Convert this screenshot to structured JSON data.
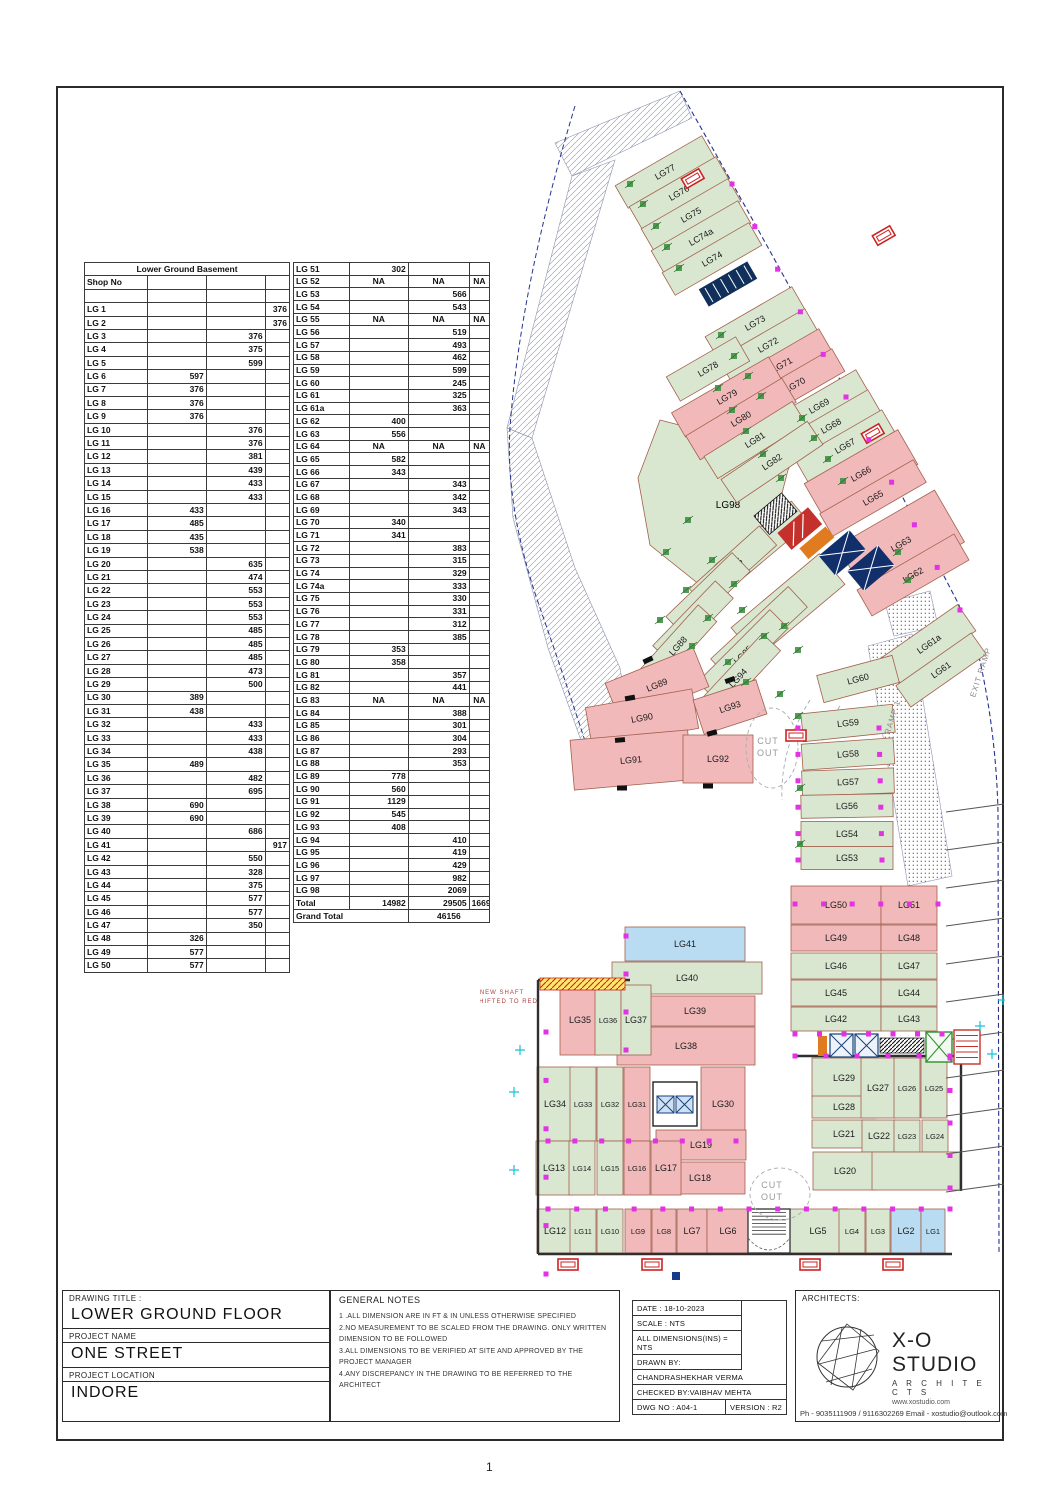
{
  "page": {
    "number": "1"
  },
  "area_table": {
    "title": "Lower Ground Basement",
    "header": "Shop No",
    "left_rows": [
      [
        "LG 1",
        "",
        "",
        "376"
      ],
      [
        "LG 2",
        "",
        "",
        "376"
      ],
      [
        "LG 3",
        "",
        "376",
        ""
      ],
      [
        "LG 4",
        "",
        "375",
        ""
      ],
      [
        "LG 5",
        "",
        "599",
        ""
      ],
      [
        "LG 6",
        "597",
        "",
        ""
      ],
      [
        "LG 7",
        "376",
        "",
        ""
      ],
      [
        "LG 8",
        "376",
        "",
        ""
      ],
      [
        "LG 9",
        "376",
        "",
        ""
      ],
      [
        "LG 10",
        "",
        "376",
        ""
      ],
      [
        "LG 11",
        "",
        "376",
        ""
      ],
      [
        "LG 12",
        "",
        "381",
        ""
      ],
      [
        "LG 13",
        "",
        "439",
        ""
      ],
      [
        "LG 14",
        "",
        "433",
        ""
      ],
      [
        "LG 15",
        "",
        "433",
        ""
      ],
      [
        "LG 16",
        "433",
        "",
        ""
      ],
      [
        "LG 17",
        "485",
        "",
        ""
      ],
      [
        "LG 18",
        "435",
        "",
        ""
      ],
      [
        "LG 19",
        "538",
        "",
        ""
      ],
      [
        "LG 20",
        "",
        "635",
        ""
      ],
      [
        "LG 21",
        "",
        "474",
        ""
      ],
      [
        "LG 22",
        "",
        "553",
        ""
      ],
      [
        "LG 23",
        "",
        "553",
        ""
      ],
      [
        "LG 24",
        "",
        "553",
        ""
      ],
      [
        "LG 25",
        "",
        "485",
        ""
      ],
      [
        "LG 26",
        "",
        "485",
        ""
      ],
      [
        "LG 27",
        "",
        "485",
        ""
      ],
      [
        "LG 28",
        "",
        "473",
        ""
      ],
      [
        "LG 29",
        "",
        "500",
        ""
      ],
      [
        "LG 30",
        "389",
        "",
        ""
      ],
      [
        "LG 31",
        "438",
        "",
        ""
      ],
      [
        "LG 32",
        "",
        "433",
        ""
      ],
      [
        "LG 33",
        "",
        "433",
        ""
      ],
      [
        "LG 34",
        "",
        "438",
        ""
      ],
      [
        "LG 35",
        "489",
        "",
        ""
      ],
      [
        "LG 36",
        "",
        "482",
        ""
      ],
      [
        "LG 37",
        "",
        "695",
        ""
      ],
      [
        "LG 38",
        "690",
        "",
        ""
      ],
      [
        "LG 39",
        "690",
        "",
        ""
      ],
      [
        "LG 40",
        "",
        "686",
        ""
      ],
      [
        "LG 41",
        "",
        "",
        "917"
      ],
      [
        "LG 42",
        "",
        "550",
        ""
      ],
      [
        "LG 43",
        "",
        "328",
        ""
      ],
      [
        "LG 44",
        "",
        "375",
        ""
      ],
      [
        "LG 45",
        "",
        "577",
        ""
      ],
      [
        "LG 46",
        "",
        "577",
        ""
      ],
      [
        "LG 47",
        "",
        "350",
        ""
      ],
      [
        "LG 48",
        "326",
        "",
        ""
      ],
      [
        "LG 49",
        "577",
        "",
        ""
      ],
      [
        "LG 50",
        "577",
        "",
        ""
      ]
    ],
    "right_rows": [
      [
        "LG 51",
        "302",
        "",
        ""
      ],
      [
        "LG 52",
        "NA",
        "NA",
        "NA"
      ],
      [
        "LG 53",
        "",
        "566",
        ""
      ],
      [
        "LG 54",
        "",
        "543",
        ""
      ],
      [
        "LG 55",
        "NA",
        "NA",
        "NA"
      ],
      [
        "LG 56",
        "",
        "519",
        ""
      ],
      [
        "LG 57",
        "",
        "493",
        ""
      ],
      [
        "LG 58",
        "",
        "462",
        ""
      ],
      [
        "LG 59",
        "",
        "599",
        ""
      ],
      [
        "LG 60",
        "",
        "245",
        ""
      ],
      [
        "LG 61",
        "",
        "325",
        ""
      ],
      [
        "LG 61a",
        "",
        "363",
        ""
      ],
      [
        "LG 62",
        "400",
        "",
        ""
      ],
      [
        "LG 63",
        "556",
        "",
        ""
      ],
      [
        "LG 64",
        "NA",
        "NA",
        "NA"
      ],
      [
        "LG 65",
        "582",
        "",
        ""
      ],
      [
        "LG 66",
        "343",
        "",
        ""
      ],
      [
        "LG 67",
        "",
        "343",
        ""
      ],
      [
        "LG 68",
        "",
        "342",
        ""
      ],
      [
        "LG 69",
        "",
        "343",
        ""
      ],
      [
        "LG 70",
        "340",
        "",
        ""
      ],
      [
        "LG 71",
        "341",
        "",
        ""
      ],
      [
        "LG 72",
        "",
        "383",
        ""
      ],
      [
        "LG 73",
        "",
        "315",
        ""
      ],
      [
        "LG 74",
        "",
        "329",
        ""
      ],
      [
        "LG 74a",
        "",
        "333",
        ""
      ],
      [
        "LG 75",
        "",
        "330",
        ""
      ],
      [
        "LG 76",
        "",
        "331",
        ""
      ],
      [
        "LG 77",
        "",
        "312",
        ""
      ],
      [
        "LG 78",
        "",
        "385",
        ""
      ],
      [
        "LG 79",
        "353",
        "",
        ""
      ],
      [
        "LG 80",
        "358",
        "",
        ""
      ],
      [
        "LG 81",
        "",
        "357",
        ""
      ],
      [
        "LG 82",
        "",
        "441",
        ""
      ],
      [
        "LG 83",
        "NA",
        "NA",
        "NA"
      ],
      [
        "LG 84",
        "",
        "388",
        ""
      ],
      [
        "LG 85",
        "",
        "301",
        ""
      ],
      [
        "LG 86",
        "",
        "304",
        ""
      ],
      [
        "LG 87",
        "",
        "293",
        ""
      ],
      [
        "LG 88",
        "",
        "353",
        ""
      ],
      [
        "LG 89",
        "778",
        "",
        ""
      ],
      [
        "LG 90",
        "560",
        "",
        ""
      ],
      [
        "LG 91",
        "1129",
        "",
        ""
      ],
      [
        "LG 92",
        "545",
        "",
        ""
      ],
      [
        "LG 93",
        "408",
        "",
        ""
      ],
      [
        "LG 94",
        "",
        "410",
        ""
      ],
      [
        "LG 95",
        "",
        "419",
        ""
      ],
      [
        "LG 96",
        "",
        "429",
        ""
      ],
      [
        "LG 97",
        "",
        "982",
        ""
      ],
      [
        "LG 98",
        "",
        "2069",
        ""
      ]
    ],
    "total_row": [
      "Total",
      "14982",
      "29505",
      "1669"
    ],
    "grand_total_label": "Grand Total",
    "grand_total_value": "46156"
  },
  "title_block": {
    "drawing_title_label": "DRAWING TITLE :",
    "drawing_title": "LOWER GROUND FLOOR",
    "project_name_label": "PROJECT NAME",
    "project_name": "ONE STREET",
    "project_location_label": "PROJECT LOCATION",
    "project_location": "INDORE",
    "general_notes_title": "GENERAL NOTES",
    "notes": [
      "1 .ALL DIMENSION ARE IN FT & IN UNLESS OTHERWISE SPECIFIED",
      "2.NO MEASUREMENT TO BE SCALED FROM THE DRAWING. ONLY WRITTEN DIMENSION TO BE FOLLOWED",
      "3.ALL DIMENSIONS TO BE VERIFIED AT SITE AND APPROVED BY THE PROJECT MANAGER",
      "4.ANY DISCREPANCY IN THE DRAWING TO BE REFERRED TO THE ARCHITECT"
    ],
    "date": "DATE : 18-10-2023",
    "scale": "SCALE : NTS",
    "all_dim": "ALL DIMENSIONS(INS) = NTS",
    "drawn_by_label": "DRAWN BY:",
    "drawn_by": "CHANDRASHEKHAR VERMA",
    "checked_by": "CHECKED BY:VAIBHAV MEHTA",
    "dwg_no": "DWG NO : A04-1",
    "version": "VERSION : R2",
    "architects_label": "ARCHITECTS:",
    "studio_name": "X-O STUDIO",
    "studio_sub": "A R C H I T E C T S",
    "studio_web": "www.xostudio.com",
    "contact": "Ph - 9035111909 / 9116302269 Email - xostudio@outlook.com"
  },
  "floor_plan": {
    "annotations": {
      "cut_out": "CUT OUT",
      "ramp1": "RAMP 1",
      "exit_ramp": "EXIT RAMP",
      "shaft_line1": "NEW SHAFT",
      "shaft_line2": "SHIFTED TO RED"
    },
    "colors": {
      "green": "#d9e7d1",
      "pink": "#f2b9bb",
      "blue": "#badcf2",
      "white": "#ffffff",
      "shop_line": "#a2604c",
      "magenta": "#e332e3",
      "navy": "#25338f",
      "plant": "#3f9142"
    },
    "big_shop": {
      "id": "LG98",
      "points": "180,332 315,367 308,382 290,452 220,497 170,457 158,390",
      "lx": 248,
      "ly": 420
    },
    "shops": [
      [
        "LG77",
        185,
        84,
        100,
        26,
        -30,
        "g"
      ],
      [
        "LG76",
        199,
        105,
        100,
        26,
        -30,
        "g"
      ],
      [
        "LG75",
        211,
        127,
        100,
        26,
        -30,
        "g"
      ],
      [
        "LC74a",
        221,
        149,
        100,
        26,
        -30,
        "g"
      ],
      [
        "LG74",
        232,
        171,
        100,
        26,
        -30,
        "g"
      ],
      [
        "LG73",
        275,
        235,
        100,
        26,
        -30,
        "g"
      ],
      [
        "LG72",
        288,
        257,
        100,
        26,
        -30,
        "g"
      ],
      [
        "LG71",
        302,
        277,
        100,
        26,
        -30,
        "p"
      ],
      [
        "LG70",
        315,
        297,
        100,
        26,
        -30,
        "p"
      ],
      [
        "LG69",
        339,
        318,
        100,
        26,
        -30,
        "g"
      ],
      [
        "LG68",
        351,
        338,
        100,
        26,
        -30,
        "g"
      ],
      [
        "LG67",
        365,
        358,
        100,
        26,
        -30,
        "g"
      ],
      [
        "LG66",
        381,
        386,
        108,
        40,
        -30,
        "p"
      ],
      [
        "LG65",
        393,
        410,
        108,
        26,
        -30,
        "p"
      ],
      [
        "LG63",
        421,
        456,
        112,
        60,
        -30,
        "p"
      ],
      [
        "LG62",
        433,
        487,
        112,
        30,
        -30,
        "p"
      ],
      [
        "LG61a",
        449,
        556,
        92,
        32,
        -35,
        "g"
      ],
      [
        "LG61",
        461,
        582,
        92,
        26,
        -35,
        "g"
      ],
      [
        "LG78",
        228,
        281,
        80,
        28,
        -30,
        "g"
      ],
      [
        "LG79",
        247,
        309,
        112,
        28,
        -30,
        "p"
      ],
      [
        "LG80",
        261,
        331,
        112,
        28,
        -31,
        "p"
      ],
      [
        "LG81",
        275,
        352,
        104,
        26,
        -32,
        "g"
      ],
      [
        "LG82",
        292,
        374,
        104,
        28,
        -34,
        "g"
      ],
      [
        "LG84",
        282,
        456,
        100,
        28,
        -40,
        "g"
      ],
      [
        "LG85",
        253,
        479,
        94,
        26,
        -42,
        "g"
      ],
      [
        "LG86",
        228,
        506,
        92,
        26,
        -44,
        "g"
      ],
      [
        "LG87",
        213,
        534,
        90,
        25,
        -46,
        "g"
      ],
      [
        "LG88",
        198,
        558,
        88,
        25,
        -48,
        "g"
      ],
      [
        "LG97",
        308,
        518,
        115,
        40,
        -40,
        "g"
      ],
      [
        "LG96",
        279,
        545,
        106,
        28,
        -43,
        "g"
      ],
      [
        "LG95",
        263,
        567,
        102,
        26,
        -45,
        "g"
      ],
      [
        "LG94",
        258,
        590,
        98,
        25,
        -47,
        "g"
      ],
      [
        "LG89",
        177,
        597,
        95,
        42,
        -22,
        "p"
      ],
      [
        "LG90",
        162,
        630,
        108,
        40,
        -10,
        "p"
      ],
      [
        "LG91",
        151,
        672,
        118,
        50,
        -5,
        "p"
      ],
      [
        "LG93",
        250,
        619,
        66,
        36,
        -18,
        "p"
      ],
      [
        "LG92",
        238,
        671,
        70,
        48,
        0,
        "p"
      ],
      [
        "LG60",
        378,
        591,
        78,
        28,
        -15,
        "g"
      ],
      [
        "LG59",
        368,
        635,
        92,
        28,
        -6,
        "g"
      ],
      [
        "LG58",
        368,
        666,
        92,
        26,
        -4,
        "g"
      ],
      [
        "LG57",
        368,
        694,
        92,
        25,
        -2,
        "g"
      ],
      [
        "LG56",
        367,
        718,
        92,
        23,
        -1,
        "g"
      ],
      [
        "LG54",
        367,
        746,
        92,
        25,
        0,
        "g"
      ],
      [
        "LG53",
        367,
        770,
        92,
        23,
        0,
        "g"
      ],
      [
        "LG50",
        356,
        817,
        90,
        38,
        0,
        "p"
      ],
      [
        "LG51",
        429,
        817,
        56,
        38,
        0,
        "p"
      ],
      [
        "LG49",
        356,
        850,
        90,
        26,
        0,
        "p"
      ],
      [
        "LG48",
        429,
        850,
        56,
        26,
        0,
        "p"
      ],
      [
        "LG46",
        356,
        878,
        90,
        26,
        0,
        "g"
      ],
      [
        "LG47",
        429,
        878,
        56,
        26,
        0,
        "g"
      ],
      [
        "LG45",
        356,
        905,
        90,
        26,
        0,
        "g"
      ],
      [
        "LG44",
        429,
        905,
        56,
        26,
        0,
        "g"
      ],
      [
        "LG42",
        356,
        931,
        90,
        24,
        0,
        "g"
      ],
      [
        "LG43",
        429,
        931,
        56,
        24,
        0,
        "g"
      ],
      [
        "LG41",
        205,
        856,
        120,
        34,
        0,
        "b"
      ],
      [
        "LG40",
        207,
        890,
        150,
        32,
        0,
        "g"
      ],
      [
        "LG39",
        215,
        923,
        120,
        30,
        0,
        "p"
      ],
      [
        "LG38",
        206,
        958,
        138,
        38,
        0,
        "p"
      ],
      [
        "LG35",
        100,
        932,
        40,
        70,
        0,
        "p"
      ],
      [
        "LG36",
        128,
        932,
        26,
        70,
        0,
        "g"
      ],
      [
        "LG37",
        156,
        932,
        30,
        70,
        0,
        "g"
      ],
      [
        "LG34",
        75,
        1016,
        36,
        74,
        0,
        "g"
      ],
      [
        "LG33",
        103,
        1016,
        26,
        74,
        0,
        "g"
      ],
      [
        "LG32",
        130,
        1016,
        26,
        74,
        0,
        "g"
      ],
      [
        "LG31",
        157,
        1016,
        26,
        74,
        0,
        "p"
      ],
      [
        "LG30",
        243,
        1016,
        44,
        74,
        0,
        "p"
      ],
      [
        "LG19",
        221,
        1057,
        90,
        30,
        0,
        "p"
      ],
      [
        "LG18",
        220,
        1090,
        90,
        32,
        0,
        "p"
      ],
      [
        "LG13",
        74,
        1080,
        36,
        54,
        0,
        "g"
      ],
      [
        "LG14",
        102,
        1080,
        26,
        54,
        0,
        "g"
      ],
      [
        "LG15",
        130,
        1080,
        26,
        54,
        0,
        "g"
      ],
      [
        "LG16",
        157,
        1080,
        26,
        54,
        0,
        "p"
      ],
      [
        "LG17",
        186,
        1080,
        30,
        54,
        0,
        "p"
      ],
      [
        "LG12",
        75,
        1143,
        36,
        44,
        0,
        "g"
      ],
      [
        "LG11",
        103,
        1143,
        26,
        44,
        0,
        "g"
      ],
      [
        "LG10",
        130,
        1143,
        26,
        44,
        0,
        "g"
      ],
      [
        "LG9",
        158,
        1143,
        26,
        44,
        0,
        "p"
      ],
      [
        "LG8",
        184,
        1143,
        24,
        44,
        0,
        "p"
      ],
      [
        "LG7",
        212,
        1143,
        30,
        44,
        0,
        "p"
      ],
      [
        "LG6",
        248,
        1143,
        42,
        44,
        0,
        "p"
      ],
      [
        "LG5",
        338,
        1143,
        60,
        44,
        0,
        "g"
      ],
      [
        "LG4",
        372,
        1143,
        26,
        44,
        0,
        "g"
      ],
      [
        "LG3",
        398,
        1143,
        24,
        44,
        0,
        "g"
      ],
      [
        "LG2",
        426,
        1143,
        30,
        44,
        0,
        "b"
      ],
      [
        "LG1",
        453,
        1143,
        24,
        44,
        0,
        "b"
      ],
      [
        "LG29",
        364,
        990,
        64,
        40,
        0,
        "g"
      ],
      [
        "LG28",
        364,
        1019,
        64,
        22,
        0,
        "g"
      ],
      [
        "LG27",
        398,
        1000,
        34,
        60,
        0,
        "g"
      ],
      [
        "LG26",
        427,
        1000,
        26,
        60,
        0,
        "g"
      ],
      [
        "LG25",
        454,
        1000,
        26,
        60,
        0,
        "g"
      ],
      [
        "LG21",
        364,
        1046,
        64,
        28,
        0,
        "g"
      ],
      [
        "LG22",
        399,
        1048,
        34,
        32,
        0,
        "g"
      ],
      [
        "LG23",
        427,
        1048,
        26,
        32,
        0,
        "g"
      ],
      [
        "LG24",
        455,
        1048,
        26,
        32,
        0,
        "g"
      ],
      [
        "LG20",
        365,
        1083,
        64,
        38,
        0,
        "g"
      ],
      [
        "",
        436,
        1083,
        88,
        38,
        0,
        "g"
      ]
    ]
  }
}
